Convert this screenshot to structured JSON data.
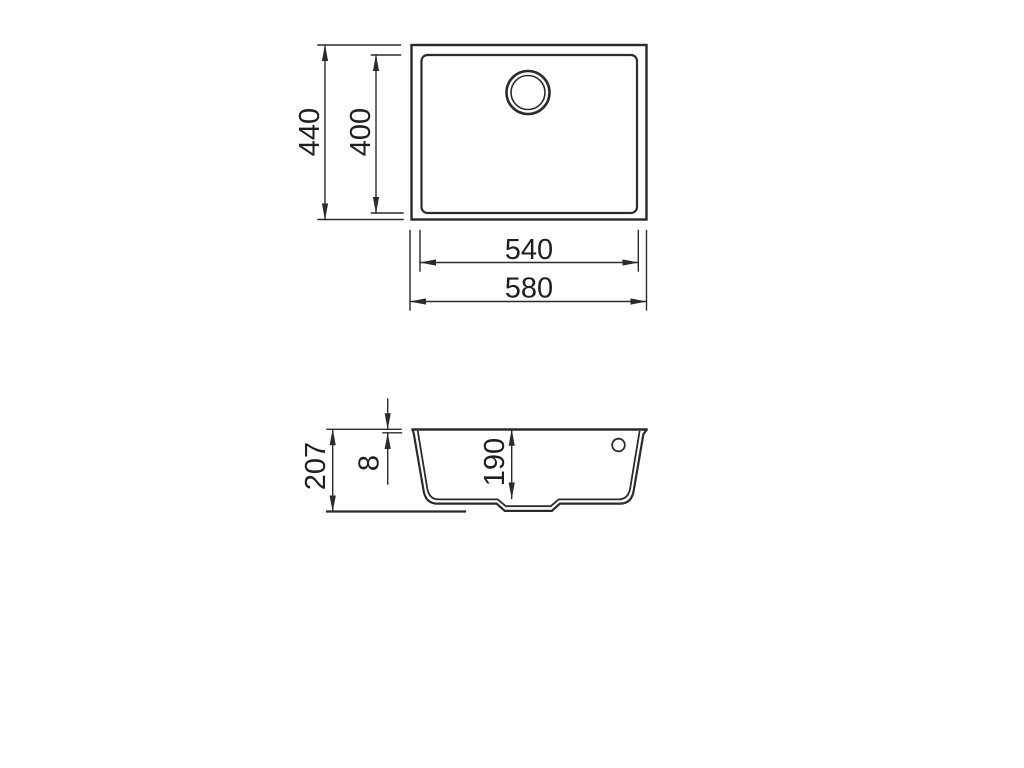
{
  "drawing": {
    "description": "Technical dimension drawing of an undermount sink: plan view and section view",
    "background": "#ffffff",
    "line_color": "#2b2b2b",
    "text_color": "#1f1f1f",
    "top_view": {
      "view_name": "plan-view",
      "dim_outer_height": "440",
      "dim_inner_height": "400",
      "dim_inner_width": "540",
      "dim_outer_width": "580"
    },
    "section_view": {
      "view_name": "section-view",
      "dim_overall_height": "207",
      "dim_rim_thickness": "8",
      "dim_bowl_depth": "190"
    }
  }
}
